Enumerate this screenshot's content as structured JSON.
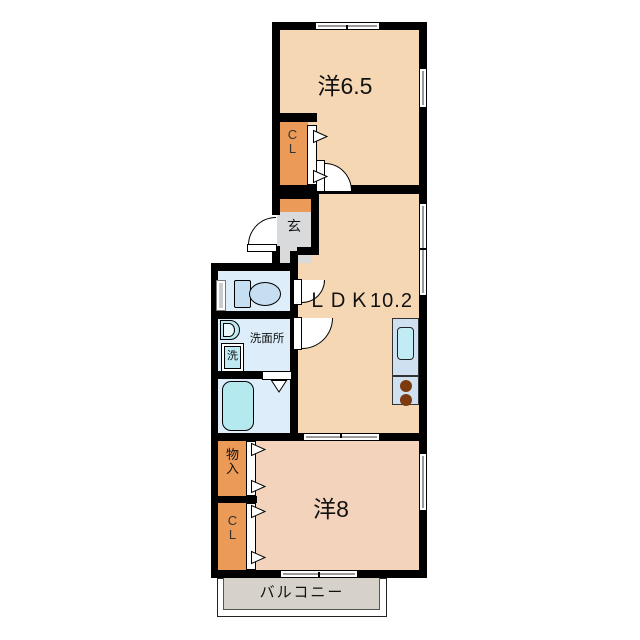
{
  "floorplan": {
    "labels": {
      "west_room_65": "洋6.5",
      "closet_upper": "C\nL",
      "entrance": "玄",
      "ldk": "ＬＤＫ10.2",
      "washroom": "洗面所",
      "washing_machine": "洗",
      "storage": "物\n入",
      "closet_lower": "C\nL",
      "west_room_8": "洋8",
      "balcony": "バルコニー"
    },
    "colors": {
      "room_fill": "#f5d7b3",
      "room_fill_south": "#f3d3bb",
      "closet_fill": "#eb9b57",
      "entrance_fill": "#d9dadb",
      "sanitary_fill": "#ddeefa",
      "fixture_fill": "#c5def2",
      "tub_fill": "#b5e9f0",
      "kitchen_fill": "#cfe1f0",
      "kitchen_sink_fill": "#c2ecf5",
      "burner_fill": "#7c3a0e",
      "balcony_fill": "#d6d2c9",
      "wall": "#000000"
    }
  }
}
